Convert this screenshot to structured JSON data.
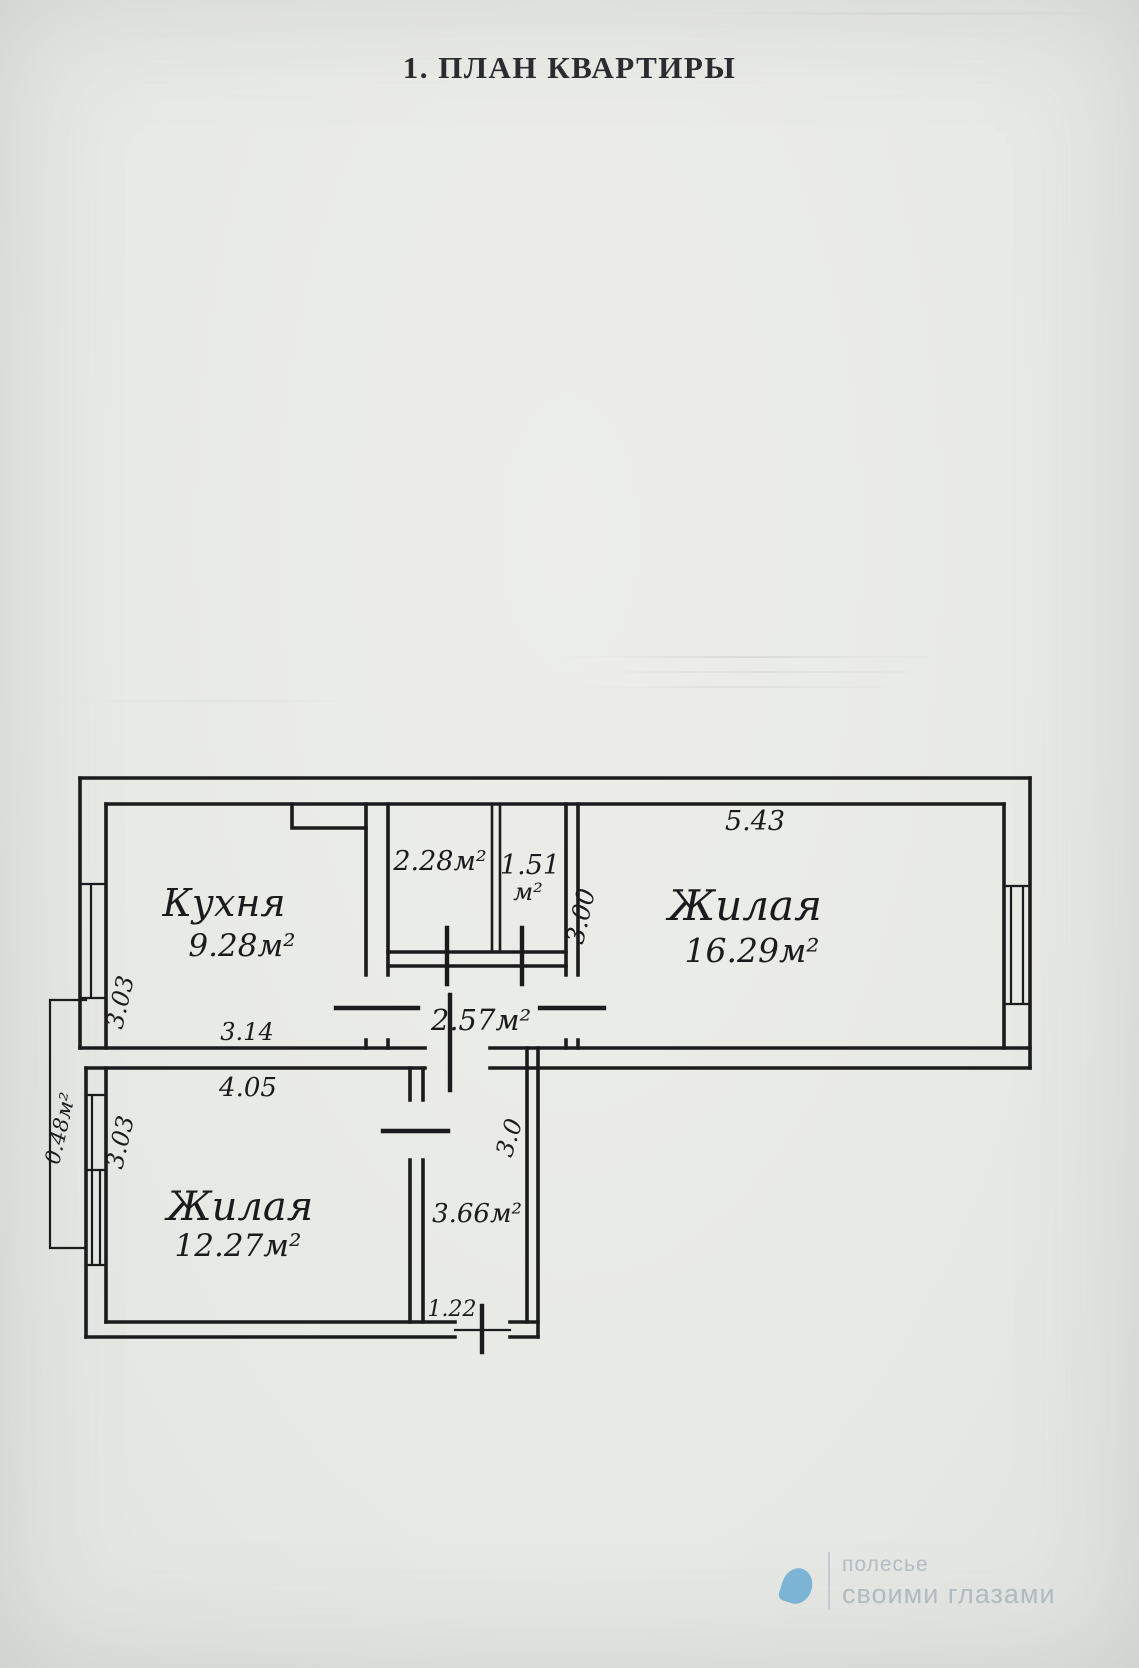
{
  "page": {
    "title": "1. ПЛАН КВАРТИРЫ"
  },
  "plan": {
    "kitchen": {
      "name": "Кухня",
      "area": "9.28м²",
      "width": "3.14",
      "height": "3.03"
    },
    "bathroom": {
      "area": "2.28м²"
    },
    "wc": {
      "area_value": "1.51",
      "area_unit": "м²"
    },
    "corridor": {
      "area": "2.57м²"
    },
    "living_right": {
      "name": "Жилая",
      "area": "16.29м²",
      "width": "5.43",
      "height": "3.00"
    },
    "living_left": {
      "name": "Жилая",
      "area": "12.27м²",
      "width": "4.05",
      "height": "3.03"
    },
    "hall": {
      "area": "3.66м²",
      "height": "3.0",
      "entrance_width": "1.22"
    },
    "balcony": {
      "area": "0.48м²"
    }
  },
  "watermark": {
    "brand": "полесье",
    "tagline": "своими глазами"
  }
}
